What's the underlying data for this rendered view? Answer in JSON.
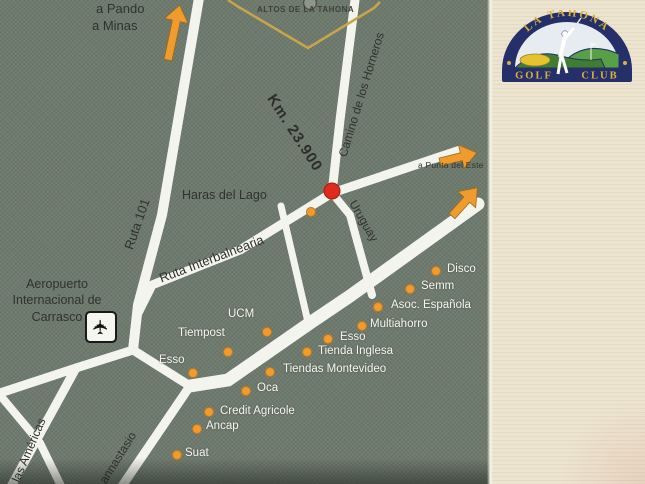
{
  "colors": {
    "map_background": "#6f7a6e",
    "road": "#f4f4ee",
    "poi_dot": "#ef9b2e",
    "marker_red": "#df2b1e",
    "panel_background": "#ece4cf",
    "logo_navy": "#25306a",
    "logo_gold": "#d9b13b",
    "diamond_gold": "#c9a44a"
  },
  "map": {
    "altos_label": "ALTOS DE LA TAHONA",
    "km_label": "Km. 23.900",
    "directions": {
      "pando": "a Pando",
      "minas": "a Minas",
      "punta_del_este": "a Punta del Este"
    },
    "airport": {
      "line1": "Aeropuerto",
      "line2": "Internacional de",
      "line3": "Carrasco"
    },
    "roads": {
      "ruta101": "Ruta 101",
      "horneros": "Camino de los Horneros",
      "interbalnearia": "Ruta Interbalnearia",
      "uruguay": "Uruguay",
      "anastasio": "annastasio",
      "americas": "las Américas"
    },
    "haras": "Haras del Lago",
    "places": [
      "Disco",
      "Semm",
      "Asoc. Española",
      "Multiahorro",
      "Esso",
      "Tienda Inglesa",
      "Tiendas Montevideo",
      "UCM",
      "Tiempost",
      "Esso",
      "Oca",
      "Credit Agricole",
      "Ancap",
      "Suat"
    ]
  },
  "panel": {
    "logo": {
      "arc_text": "LA TAHONA",
      "golf": "GOLF",
      "club": "CLUB"
    }
  }
}
